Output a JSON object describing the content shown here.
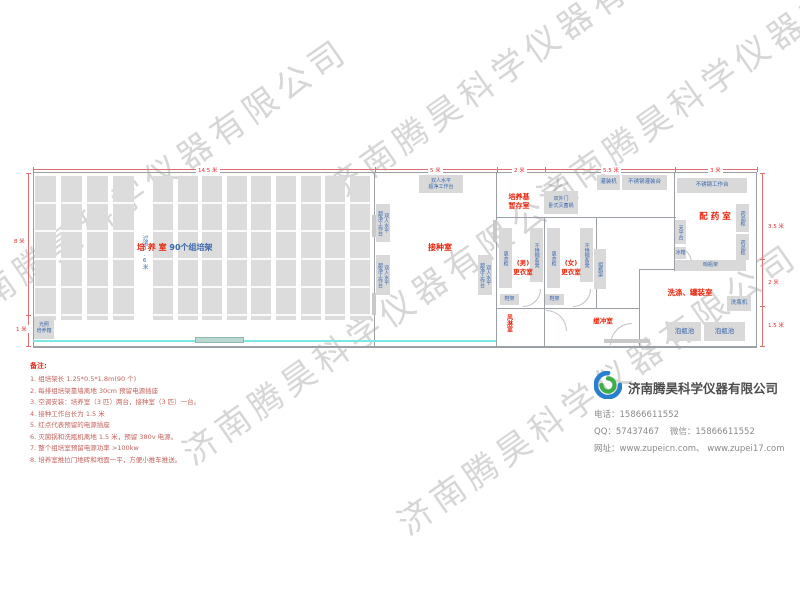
{
  "watermark": "济南腾昊科学仪器有限公司",
  "rooms": {
    "culture": {
      "name": "培 养 室",
      "racks": "90个组培架",
      "aisle": "过道0.6米"
    },
    "inoculation": {
      "name": "接种室"
    },
    "medium_storage": {
      "name": "培养基\n暂存室"
    },
    "men_changing": {
      "name": "(男)\n更衣室"
    },
    "women_changing": {
      "name": "(女)\n更衣室"
    },
    "air_shower": {
      "name": "风淋室"
    },
    "buffer": {
      "name": "缓冲室"
    },
    "pharmacy": {
      "name": "配 药 室"
    },
    "washing": {
      "name": "洗涤、罐装室"
    }
  },
  "equipment": {
    "clean_bench": {
      "label": "双人水平\n超净工作台"
    },
    "sterilizer": {
      "label": "双外门\n卧式灭菌锅"
    },
    "locker": {
      "label": "更衣柜"
    },
    "steel_bench": {
      "label": "不锈钢条凳"
    },
    "shoe_rack": {
      "label": "鞋架"
    },
    "bottle_rack": {
      "label": "组瓶架"
    },
    "filling_machine": {
      "label": "灌装机"
    },
    "filling_table": {
      "label": "不锈钢灌装台"
    },
    "work_table": {
      "label": "不锈钢工作台"
    },
    "balance_table": {
      "label": "天平台"
    },
    "fridge": {
      "label": "冰箱"
    },
    "drying_rack": {
      "label": "晾瓶架"
    },
    "medicine_cabinet": {
      "label": "药品柜"
    },
    "bottle_washer": {
      "label": "洗瓶机"
    },
    "soaking_pool": {
      "label": "泡瓶池"
    },
    "incubator": {
      "label": "光照\n培养箱"
    }
  },
  "dimensions": {
    "top": [
      "14.5 米",
      "5 米",
      "2 米",
      "5.5 米",
      "3 米"
    ],
    "left": [
      "8 米",
      "1 米"
    ],
    "right": [
      "3.5 米",
      "2 米",
      "1.5 米"
    ]
  },
  "notes": {
    "title": "备注:",
    "items": [
      "1.  组培架长 1.25*0.5*1.8m(90 个)",
      "2.  每排组培架靠墙离地 30cm 预留电源插座",
      "3.  空调安装：培养室（3 匹）两台，接种室（3 匹）一台。",
      "4.  接种工作台长为 1.5 米",
      "5.  红点代表预留的电源插座",
      "6.  灭菌锅和洗瓶机离地 1.5 米，预留 380v 电源。",
      "7.  整个组培室预留电源功率 >100kw",
      "8.  培养室推拉门地砖和地面一平，方便小推车推送。"
    ]
  },
  "company": {
    "name": "济南腾昊科学仪器有限公司",
    "phone_label": "电话：",
    "phone": "15866611552",
    "qq_label": "QQ：",
    "qq": "57437467",
    "wechat_label": "微信：",
    "wechat": "15866611552",
    "web_label": "网址：",
    "web": "www.zupeicn.com、 www.zupei17.com"
  }
}
